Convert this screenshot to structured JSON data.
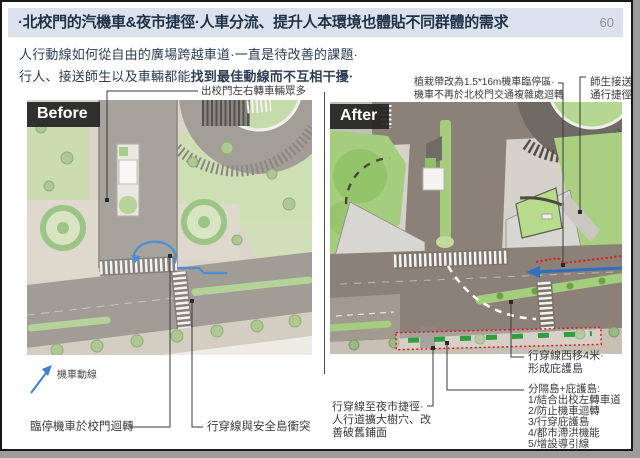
{
  "title": {
    "text": "·北校門的汽機車&夜市捷徑·人車分流、提升人本環境也體貼不同群體的需求",
    "page_number": "60"
  },
  "body": {
    "line1": "人行動線如何從自由的廣場跨越車道·一直是待改善的課題·",
    "line2_normal": "行人、接送師生以及車輛都能",
    "line2_bold": "找到最佳動線而不互相干擾·"
  },
  "panels": {
    "before": {
      "label": "Before"
    },
    "after": {
      "label": "After"
    }
  },
  "annotations": {
    "before_top": "出校門左右轉車輛眾多",
    "moto_legend": "機車動線",
    "before_bottom_left": "臨停機車於校門迴轉",
    "before_bottom_right": "行穿線與安全島衝突",
    "after_top_line1": "植栽帶改為1.5*16m機車臨停區·",
    "after_top_line2": "機車不再於北校門交通複雜處迴轉",
    "after_topright_line1": "師生接送",
    "after_topright_line2": "通行捷徑",
    "after_right_line1": "行穿線西移4米·",
    "after_right_line2": "形成庇護島",
    "after_list_title": "分隔島+庇護島:",
    "after_list": [
      "1/結合出校左轉車道",
      "2/防止機車迴轉",
      "3/行穿庇護島",
      "4/都市滯洪機能",
      "5/增設導引線"
    ],
    "after_bottomleft_line1": "行穿線至夜市捷徑·",
    "after_bottomleft_line2": "人行道擴大樹穴、改",
    "after_bottomleft_line3": "善破舊鋪面"
  },
  "colors": {
    "titlebar_bg": "#dbe2ee",
    "title_text": "#1e3146",
    "label_bg": "#242423",
    "path_blue": "#3c7fd0",
    "annotation_red": "#e01818",
    "median_green": "#a5cd7e",
    "road_gray": "#a19c96",
    "road_brown": "#8b8179"
  }
}
